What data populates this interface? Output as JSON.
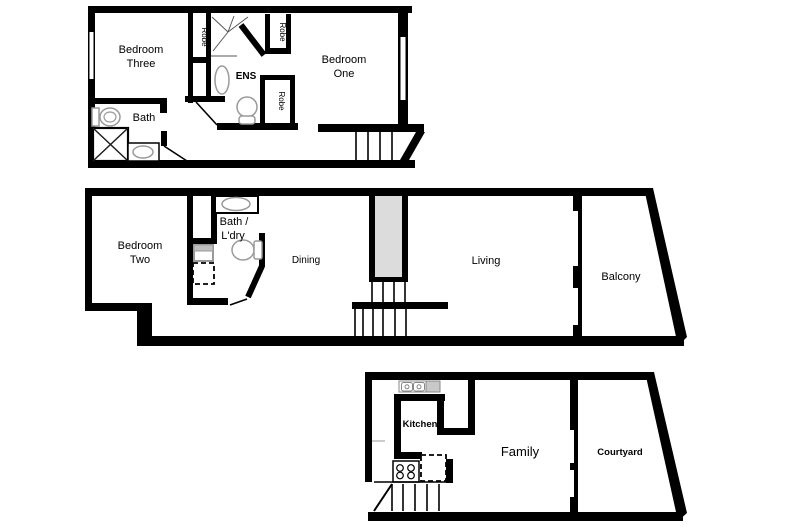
{
  "document": {
    "type": "floor-plan",
    "levels": 3
  },
  "colors": {
    "wall": "#000000",
    "background": "#ffffff",
    "stair_shaft": "#dcdcdc",
    "drainer_gray": "#c8c8c8",
    "appliance_gray": "#c0c0c0",
    "fixture_gray": "#9a9a9a"
  },
  "floors": {
    "upper": {
      "rooms": {
        "bedroom_three": {
          "line1": "Bedroom",
          "line2": "Three"
        },
        "bedroom_one": {
          "line1": "Bedroom",
          "line2": "One"
        },
        "bath": "Bath",
        "ens": "ENS",
        "robe_left": "Robe",
        "robe_upper_right": "Robe",
        "robe_lower_right": "Robe"
      }
    },
    "middle": {
      "rooms": {
        "bedroom_two": {
          "line1": "Bedroom",
          "line2": "Two"
        },
        "bath_laundry": {
          "line1": "Bath /",
          "line2": "L'dry"
        },
        "dining": "Dining",
        "living": "Living",
        "balcony": "Balcony"
      }
    },
    "ground": {
      "rooms": {
        "kitchen": "Kitchen",
        "family": "Family",
        "courtyard": "Courtyard"
      }
    }
  }
}
